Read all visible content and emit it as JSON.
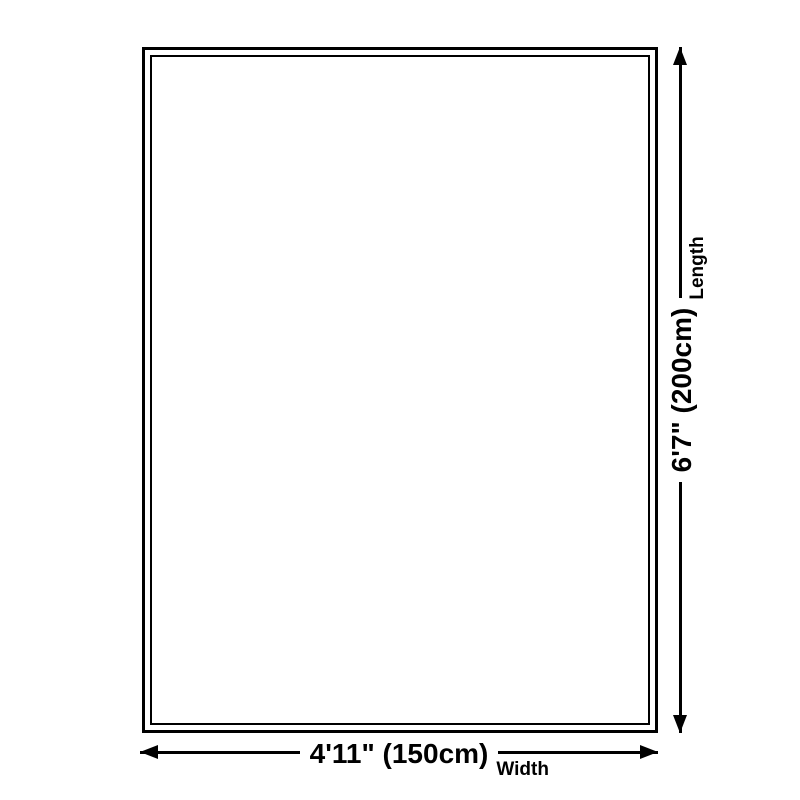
{
  "diagram": {
    "type": "product-size-diagram",
    "shape": "rectangle",
    "colors": {
      "line": "#000000",
      "background": "#ffffff"
    },
    "length": {
      "value_label": "6'7\" (200cm)",
      "axis_label": "Length",
      "orientation": "vertical"
    },
    "width": {
      "value_label": "4'11\" (150cm)",
      "axis_label": "Width",
      "orientation": "horizontal"
    }
  }
}
